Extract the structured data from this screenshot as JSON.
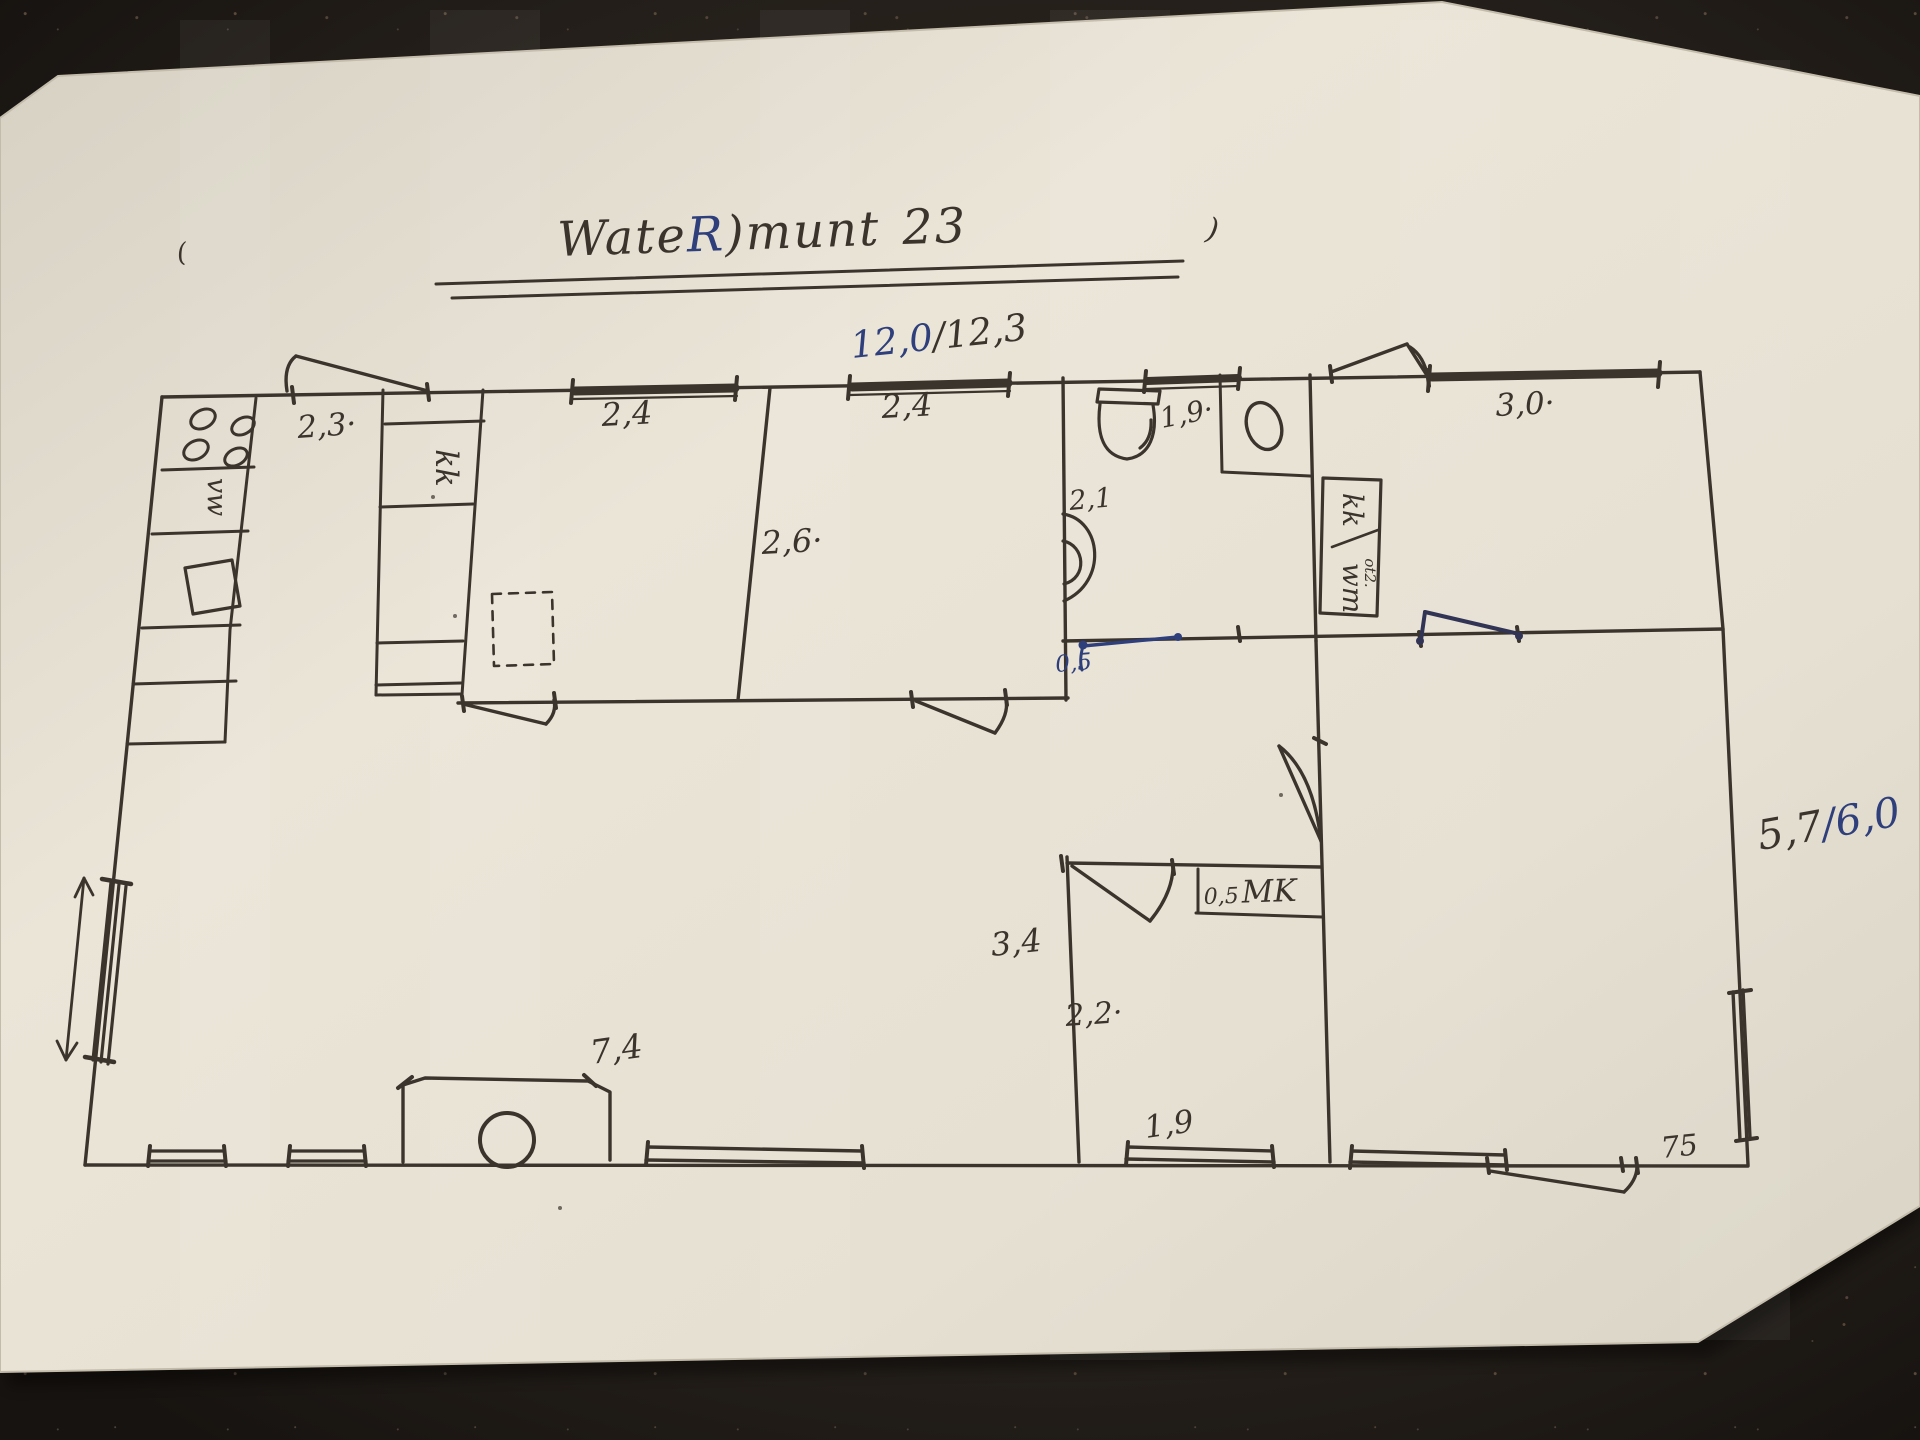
{
  "title": {
    "part1": "Wate",
    "accent": "R",
    "part2": ")munt",
    "part3": "23"
  },
  "marks": {
    "left_paren": "(",
    "right_paren": ")"
  },
  "dims": {
    "overall": {
      "a": "12,0",
      "b": "/12,3"
    },
    "kitchen": "2,3·",
    "bed1_window": "2,4",
    "bed2_window": "2,4",
    "bed_depth": "2,6·",
    "bath_window": "1,9·",
    "bath_depth": "2,1",
    "bath_door": "0,5",
    "right_window": "3,0·",
    "side": {
      "a": "5,7",
      "b": "/6,0"
    },
    "living": "3,4",
    "mid_room": "2,2·",
    "meter_width": "0,5",
    "stove_bay": "7,4",
    "bottom_window": "1,9",
    "door_offset": "75"
  },
  "units": {
    "fridge": "kk",
    "dishwasher": "vw",
    "laundry_top": "kk",
    "laundry_bottom": "wm",
    "laundry_note": "ot2.",
    "meter_closet": "MK"
  },
  "colors": {
    "ink": "#3a342d",
    "blue_ink": "#2e3f7b",
    "paper": "#e9e3d5",
    "background": "#241f1a"
  }
}
